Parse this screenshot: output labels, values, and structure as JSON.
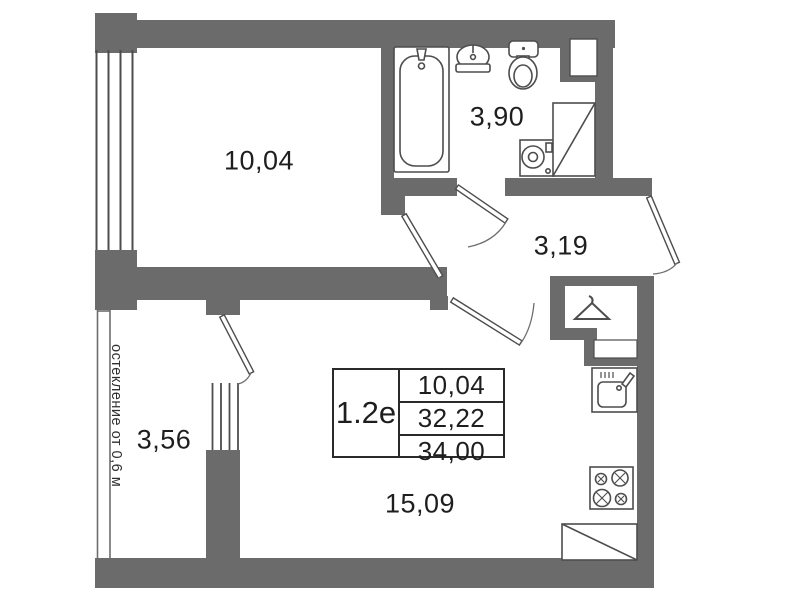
{
  "floor_plan": {
    "unit": {
      "label": "1.2е"
    },
    "info_table": {
      "rows": [
        "10,04",
        "32,22",
        "34,00"
      ]
    },
    "rooms": {
      "bedroom": {
        "area": "10,04"
      },
      "bathroom": {
        "area": "3,90"
      },
      "hallway": {
        "area": "3,19"
      },
      "balcony": {
        "area": "3,56"
      },
      "living_kitchen": {
        "area": "15,09"
      }
    },
    "notes": {
      "glazing": "остекление от 0,6 м"
    },
    "colors": {
      "wall": "#6b6b6b",
      "fixture_line": "#4d4d4d",
      "text": "#1e1e1e"
    }
  }
}
